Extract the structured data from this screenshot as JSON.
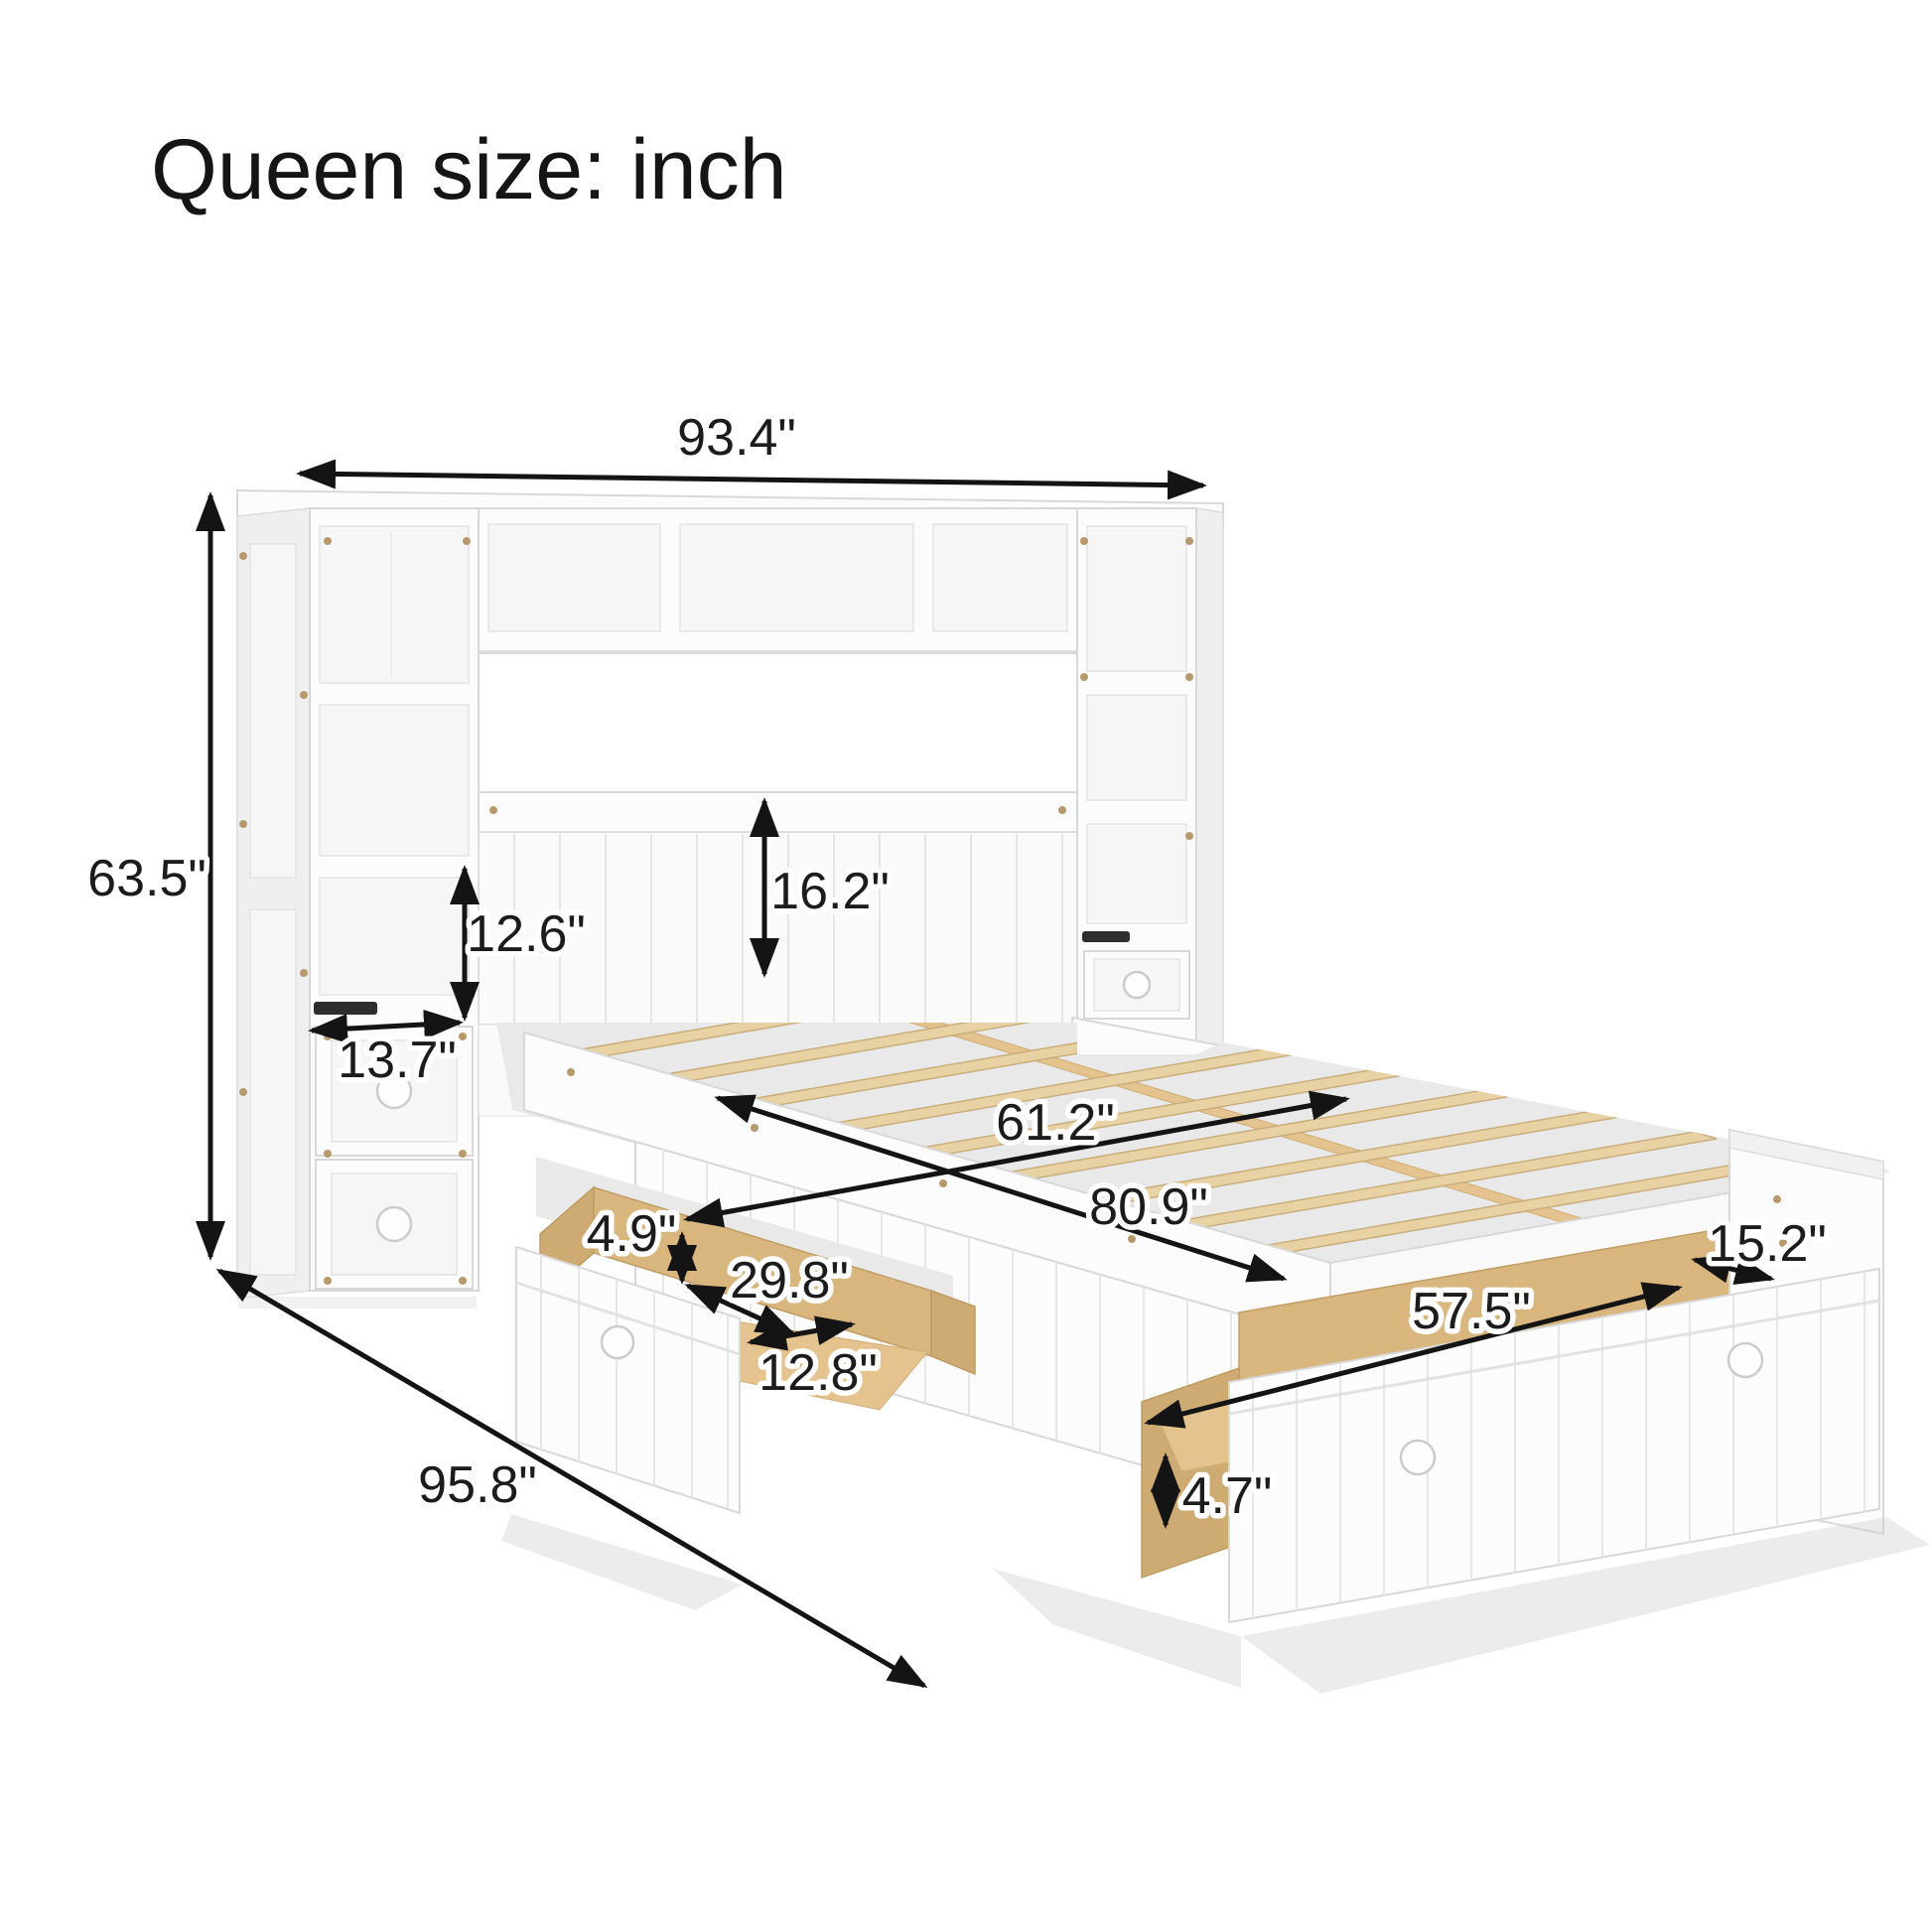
{
  "title": "Queen size: inch",
  "diagram": {
    "type": "furniture-dimension-diagram",
    "product": "queen storage bed with pier wall bookcase headboard, side drawer and trundle drawer",
    "unit": "inch",
    "colors": {
      "wood": "#e8d2a4",
      "furniture_white": "#fcfcfc",
      "dimension_line": "#141414"
    }
  },
  "dims": [
    {
      "id": "overall-width",
      "value": "93.4\""
    },
    {
      "id": "overall-height",
      "value": "63.5\""
    },
    {
      "id": "shelf-opening-height",
      "value": "12.6\""
    },
    {
      "id": "headboard-height",
      "value": "16.2\""
    },
    {
      "id": "pier-shelf-width",
      "value": "13.7\""
    },
    {
      "id": "bed-width",
      "value": "61.2\""
    },
    {
      "id": "bed-length",
      "value": "80.9\""
    },
    {
      "id": "side-drawer-height",
      "value": "4.9\""
    },
    {
      "id": "side-drawer-length",
      "value": "29.8\""
    },
    {
      "id": "side-drawer-depth",
      "value": "12.8\""
    },
    {
      "id": "trundle-length",
      "value": "57.5\""
    },
    {
      "id": "trundle-depth",
      "value": "15.2\""
    },
    {
      "id": "trundle-height",
      "value": "4.7\""
    },
    {
      "id": "overall-depth",
      "value": "95.8\""
    }
  ]
}
